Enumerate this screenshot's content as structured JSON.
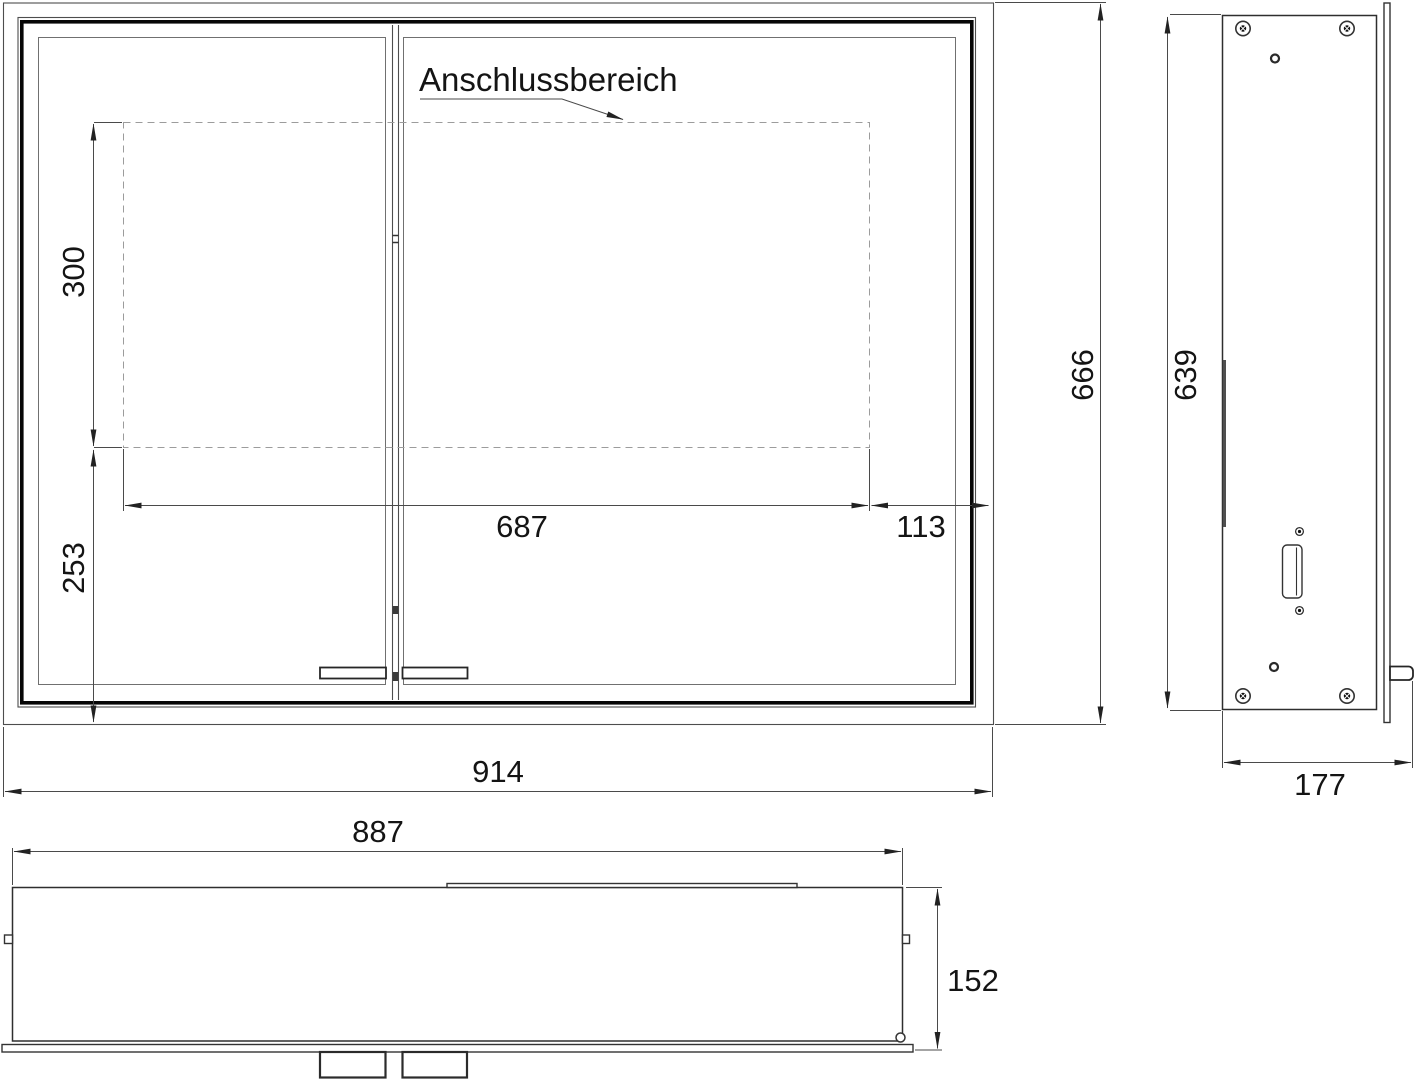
{
  "drawing": {
    "connection_area": {
      "label": "Anschlussbereich"
    },
    "front_view": {
      "dim_connect_height": "300",
      "dim_bottom_offset": "253",
      "dim_connect_width": "687",
      "dim_right_offset": "113",
      "dim_total_width": "914",
      "dim_total_height": "666"
    },
    "side_view": {
      "dim_body_height": "639",
      "dim_total_depth": "177"
    },
    "bottom_view": {
      "dim_body_width": "887",
      "dim_total_depth": "152"
    }
  }
}
